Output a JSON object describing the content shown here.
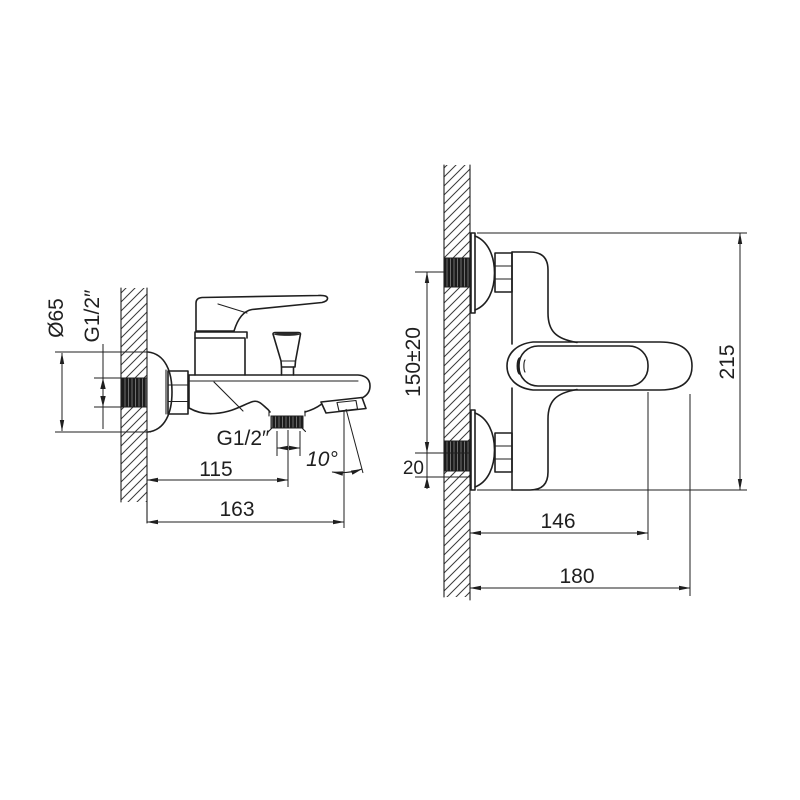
{
  "page": {
    "background": "#ffffff",
    "line_color": "#1f1f1f"
  },
  "views": {
    "side_view": {
      "labels": {
        "flange_diameter": "Ø65",
        "inlet_thread": "G1/2″",
        "outlet_thread": "G1/2″",
        "wall_to_outlet": "115",
        "wall_to_spout_tip": "163",
        "spout_angle": "10°"
      }
    },
    "front_view": {
      "labels": {
        "inlet_spacing": "150±20",
        "eccentric_offset": "20",
        "overall_height": "215",
        "wall_to_handle": "146",
        "overall_projection": "180"
      }
    }
  }
}
